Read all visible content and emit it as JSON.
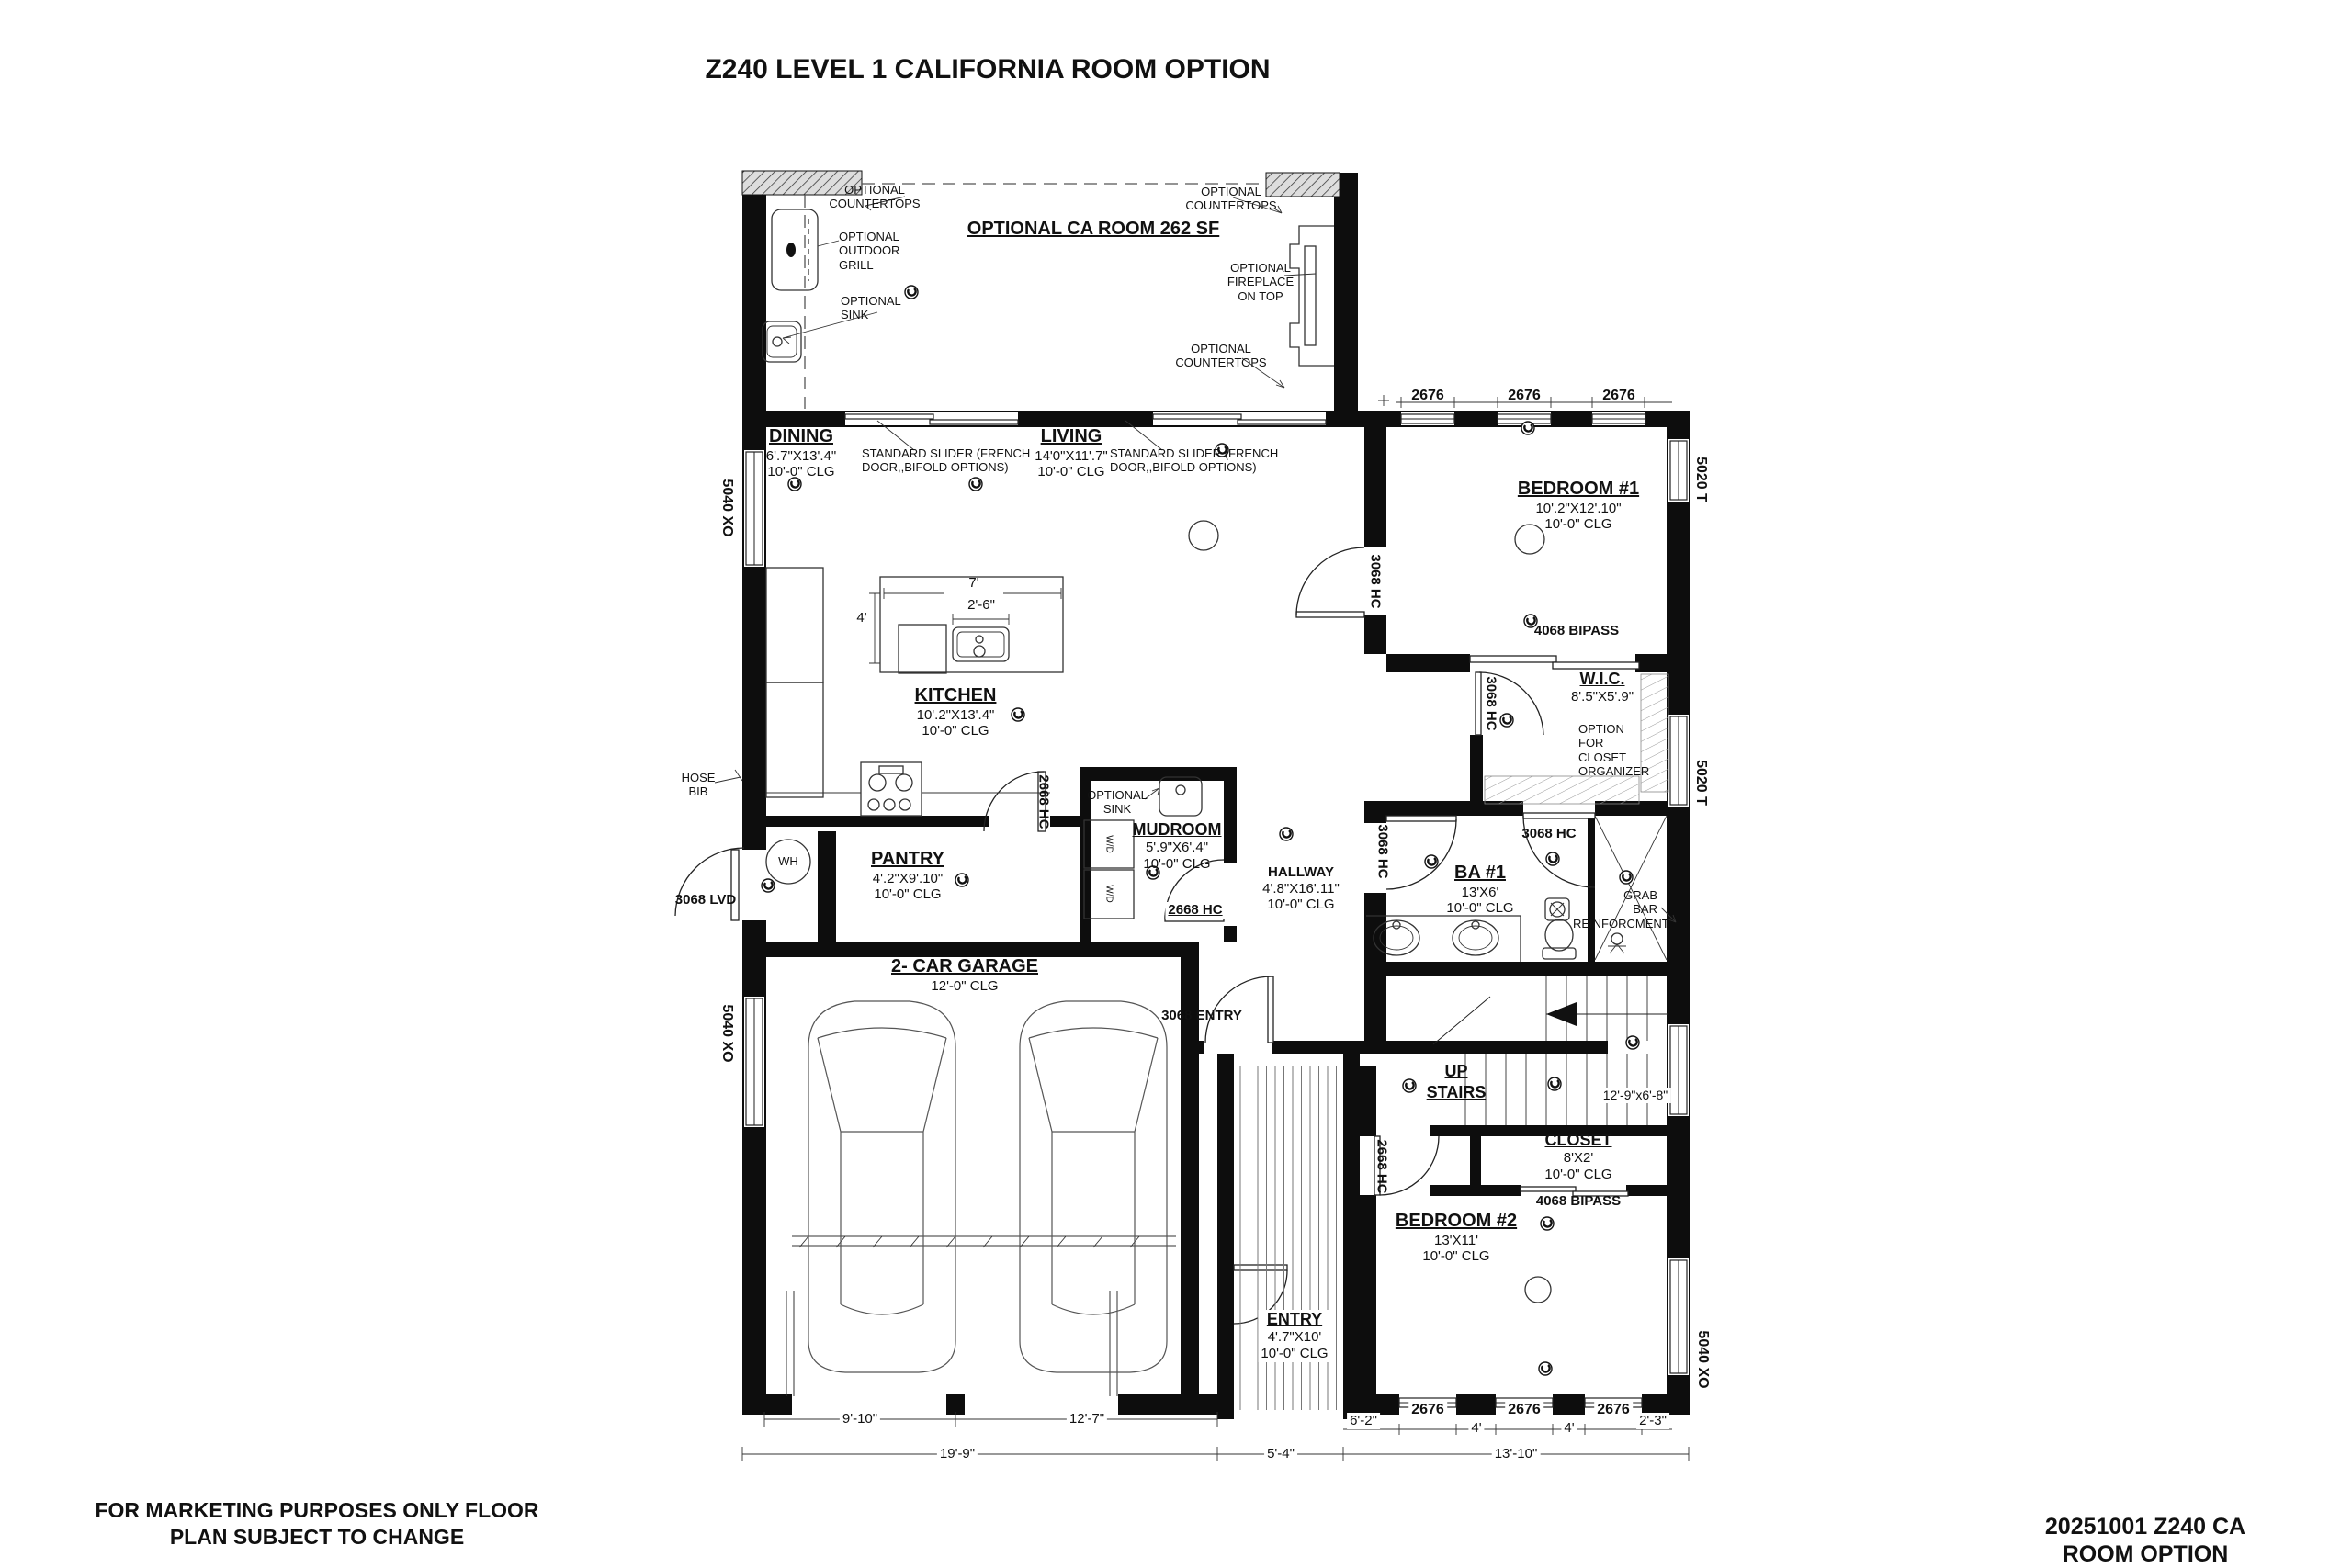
{
  "title": "Z240 LEVEL 1 CALIFORNIA ROOM OPTION",
  "footer": {
    "disclaimer": "FOR MARKETING PURPOSES ONLY FLOOR\nPLAN SUBJECT TO CHANGE",
    "plan_id": "20251001 Z240 CA ROOM OPTION"
  },
  "rooms": {
    "ca_room": {
      "name": "OPTIONAL CA ROOM 262 SF"
    },
    "dining": {
      "name": "DINING",
      "size": "6'.7\"X13'.4\"",
      "ceiling": "10'-0\" CLG"
    },
    "living": {
      "name": "LIVING",
      "size": "14'0\"X11'.7\"",
      "ceiling": "10'-0\" CLG"
    },
    "kitchen": {
      "name": "KITCHEN",
      "size": "10'.2\"X13'.4\"",
      "ceiling": "10'-0\" CLG"
    },
    "bedroom1": {
      "name": "BEDROOM #1",
      "size": "10'.2\"X12'.10\"",
      "ceiling": "10'-0\" CLG"
    },
    "wic": {
      "name": "W.I.C.",
      "size": "8'.5\"X5'.9\""
    },
    "pantry": {
      "name": "PANTRY",
      "size": "4'.2\"X9'.10\"",
      "ceiling": "10'-0\" CLG"
    },
    "mudroom": {
      "name": "MUDROOM",
      "size": "5'.9\"X6'.4\"",
      "ceiling": "10'-0\" CLG"
    },
    "hallway": {
      "name": "HALLWAY",
      "size": "4'.8\"X16'.11\"",
      "ceiling": "10'-0\" CLG"
    },
    "bath1": {
      "name": "BA #1",
      "size": "13'X6'",
      "ceiling": "10'-0\" CLG"
    },
    "garage": {
      "name": "2- CAR GARAGE",
      "ceiling": "12'-0\" CLG"
    },
    "stairs": {
      "up": "UP",
      "label": "STAIRS",
      "size": "12'-9\"x6'-8\""
    },
    "closet": {
      "name": "CLOSET",
      "size": "8'X2'",
      "ceiling": "10'-0\" CLG"
    },
    "bedroom2": {
      "name": "BEDROOM #2",
      "size": "13'X11'",
      "ceiling": "10'-0\" CLG"
    },
    "entry": {
      "name": "ENTRY",
      "size": "4'.7\"X10'",
      "ceiling": "10'-0\" CLG"
    }
  },
  "annotations": {
    "countertops": "OPTIONAL\nCOUNTERTOPS",
    "outdoor_grill": "OPTIONAL\nOUTDOOR\nGRILL",
    "opt_sink": "OPTIONAL\nSINK",
    "fireplace": "OPTIONAL\nFIREPLACE\nON TOP",
    "slider": "STANDARD SLIDER (FRENCH\nDOOR,,BIFOLD OPTIONS)",
    "closet_organizer": "OPTION\nFOR\nCLOSET\nORGANIZER",
    "grab_bar": "GRAB\nBAR\nREINFORCMENT",
    "hose_bib": "HOSE\nBIB",
    "water_heater": "WH",
    "washer_dryer": "W/D"
  },
  "doors": {
    "lvd3068": "3068 LVD",
    "hc2668": "2668 HC",
    "hc3068": "3068 HC",
    "entry3068": "3068 ENTRY",
    "bipass4068": "4068 BIPASS"
  },
  "windows": {
    "w2676": "2676",
    "xo5040": "5040 XO",
    "t5020": "5020 T"
  },
  "island": {
    "w": "7'",
    "d": "4'",
    "sink": "2'-6\""
  },
  "dimensions": {
    "garage_l": "9'-10\"",
    "garage_r": "12'-7\"",
    "garage_total": "19'-9\"",
    "porch": "5'-4\"",
    "offset": "6'-2\"",
    "bed2_total": "13'-10\"",
    "gap4": "4'",
    "corner": "2'-3\""
  }
}
